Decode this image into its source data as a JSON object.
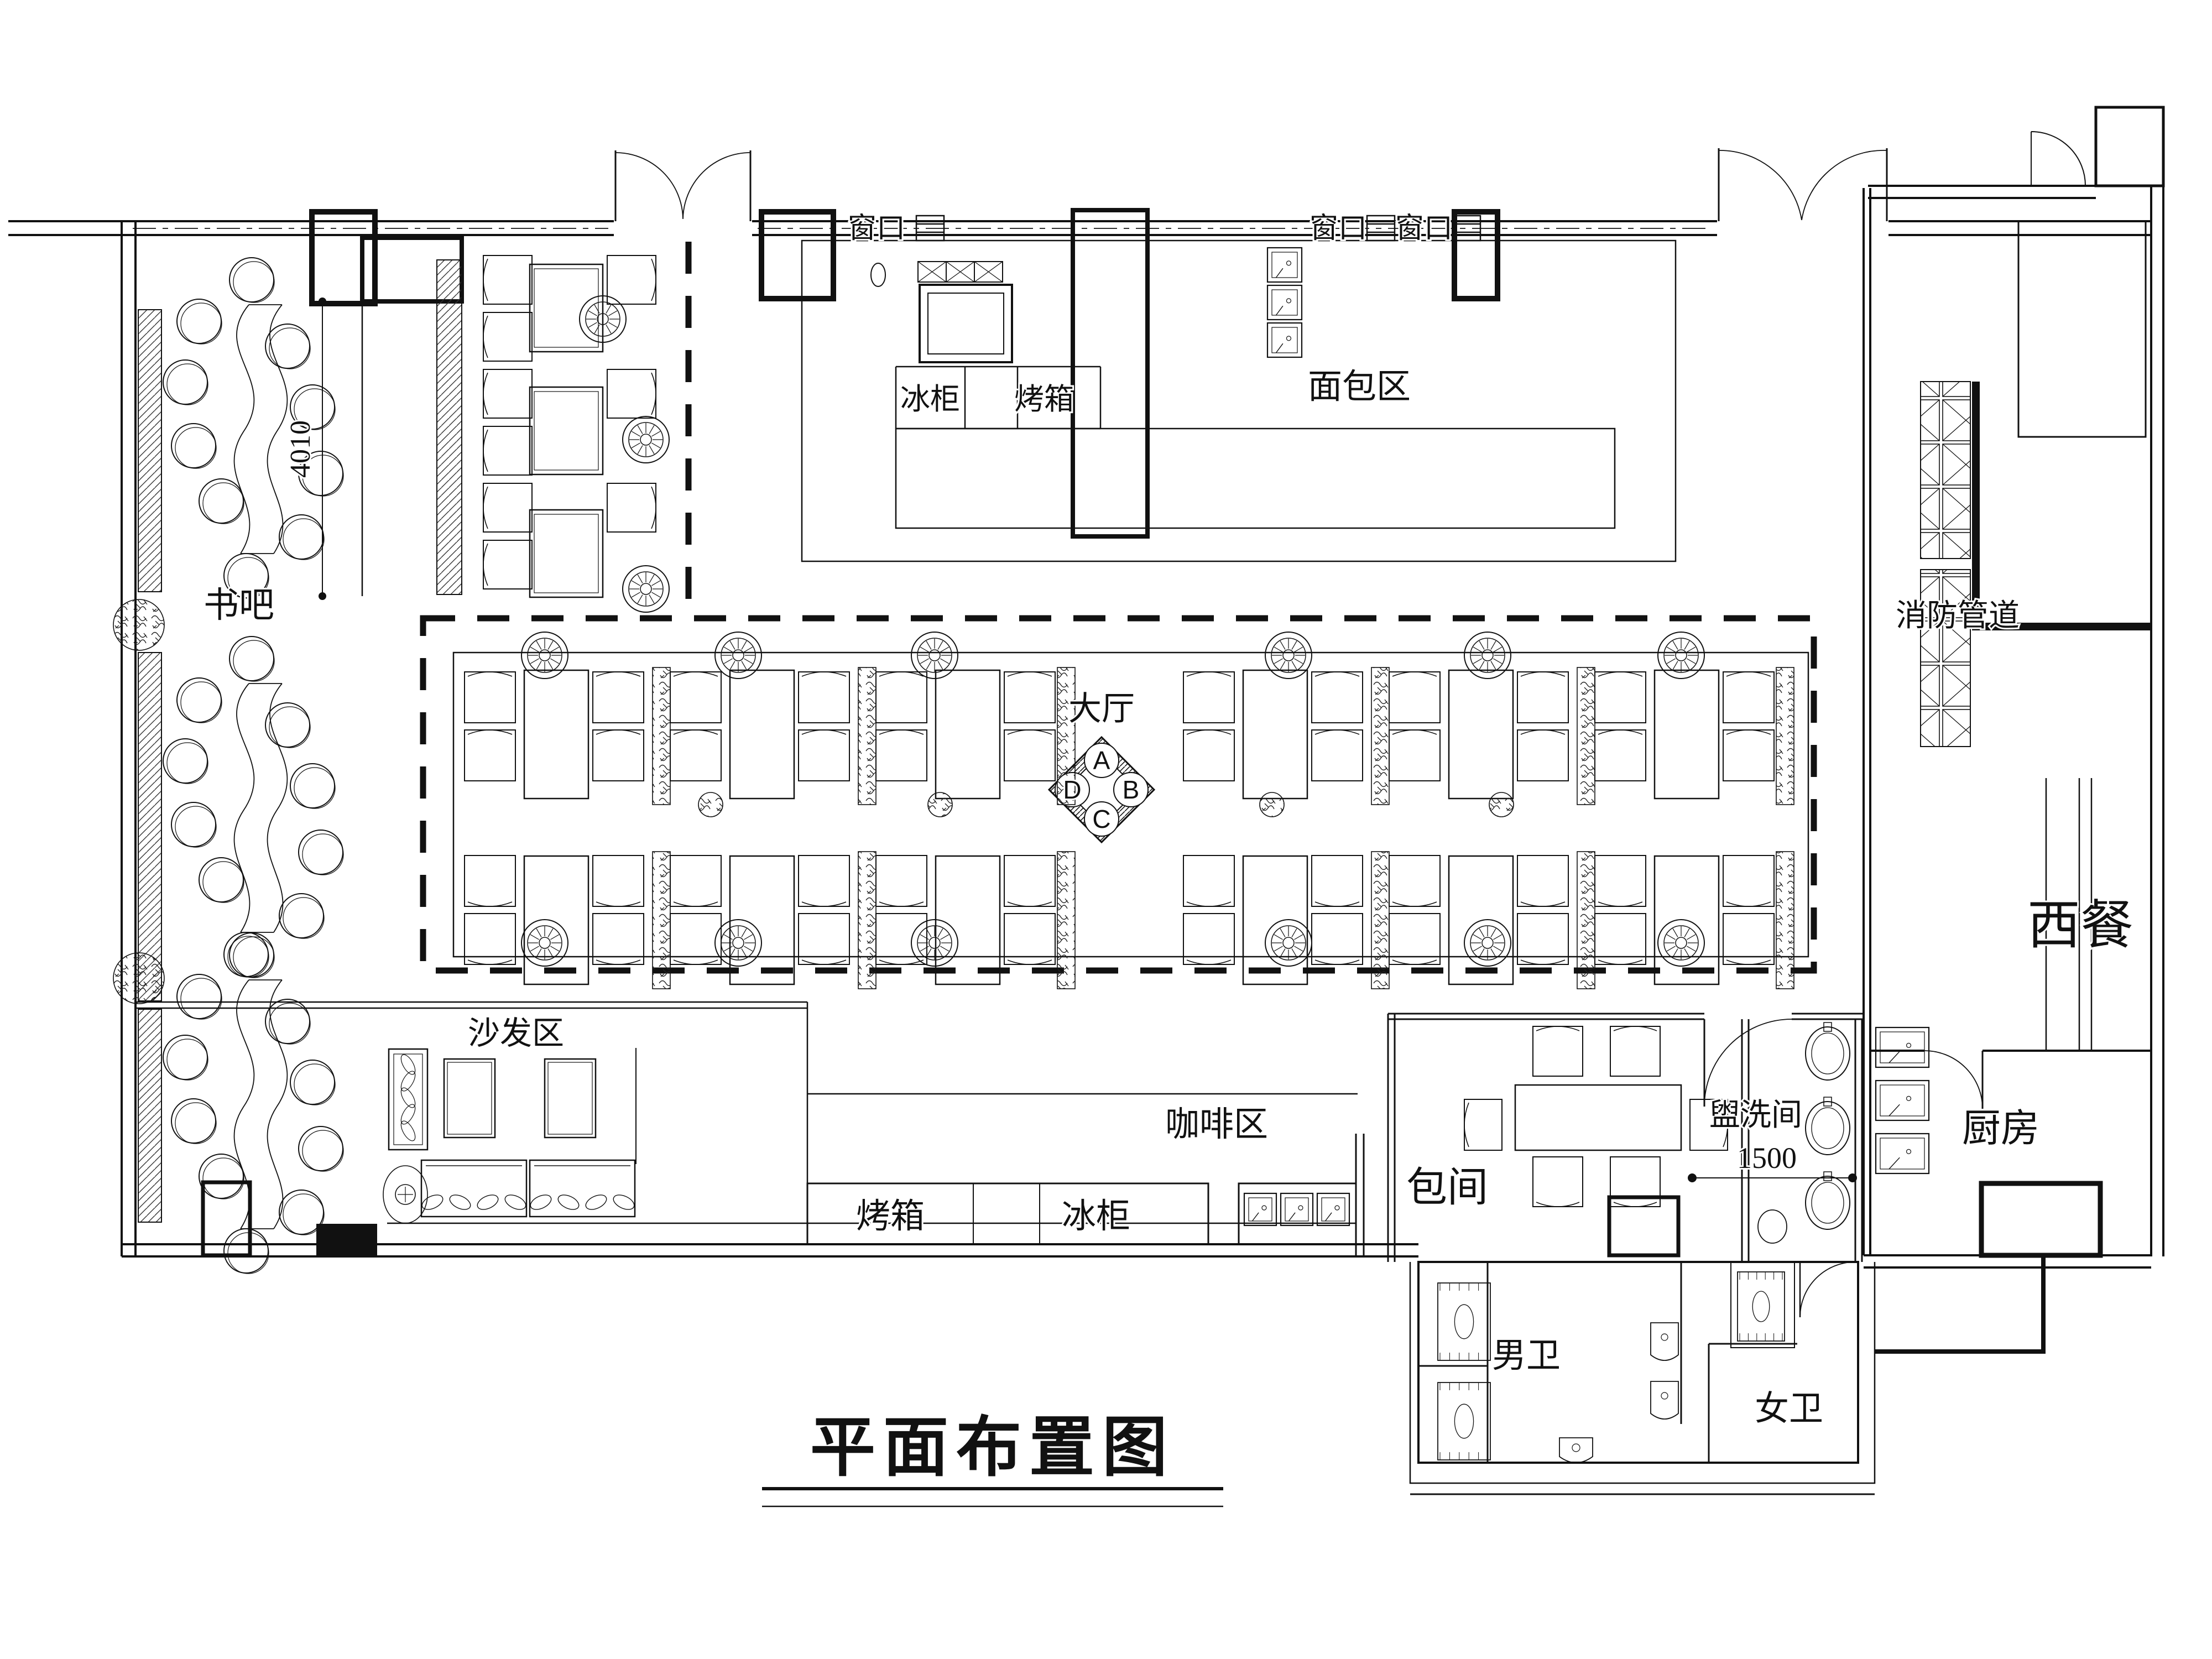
{
  "drawing": {
    "title": "平面布置图"
  },
  "labels": {
    "book_bar": "书吧",
    "main_hall": "大厅",
    "bread_area": "面包区",
    "sofa_area": "沙发区",
    "coffee_area": "咖啡区",
    "private_room": "包间",
    "washroom": "盥洗间",
    "kitchen": "厨房",
    "mens_toilet": "男卫",
    "womens_toilet": "女卫",
    "western_dining": "西餐",
    "fire_duct": "消防管道",
    "window1": "窗口",
    "window2": "窗口",
    "window3": "窗口",
    "freezer_bakery": "冰柜",
    "oven_bakery": "烤箱",
    "oven_coffee": "烤箱",
    "freezer_coffee": "冰柜"
  },
  "dimensions": {
    "book_bar_depth": "4010",
    "aisle_width": "1500"
  },
  "compass": {
    "top": "A",
    "right": "B",
    "bottom": "C",
    "left": "D"
  },
  "colors": {
    "line": "#111111",
    "background": "#ffffff"
  }
}
